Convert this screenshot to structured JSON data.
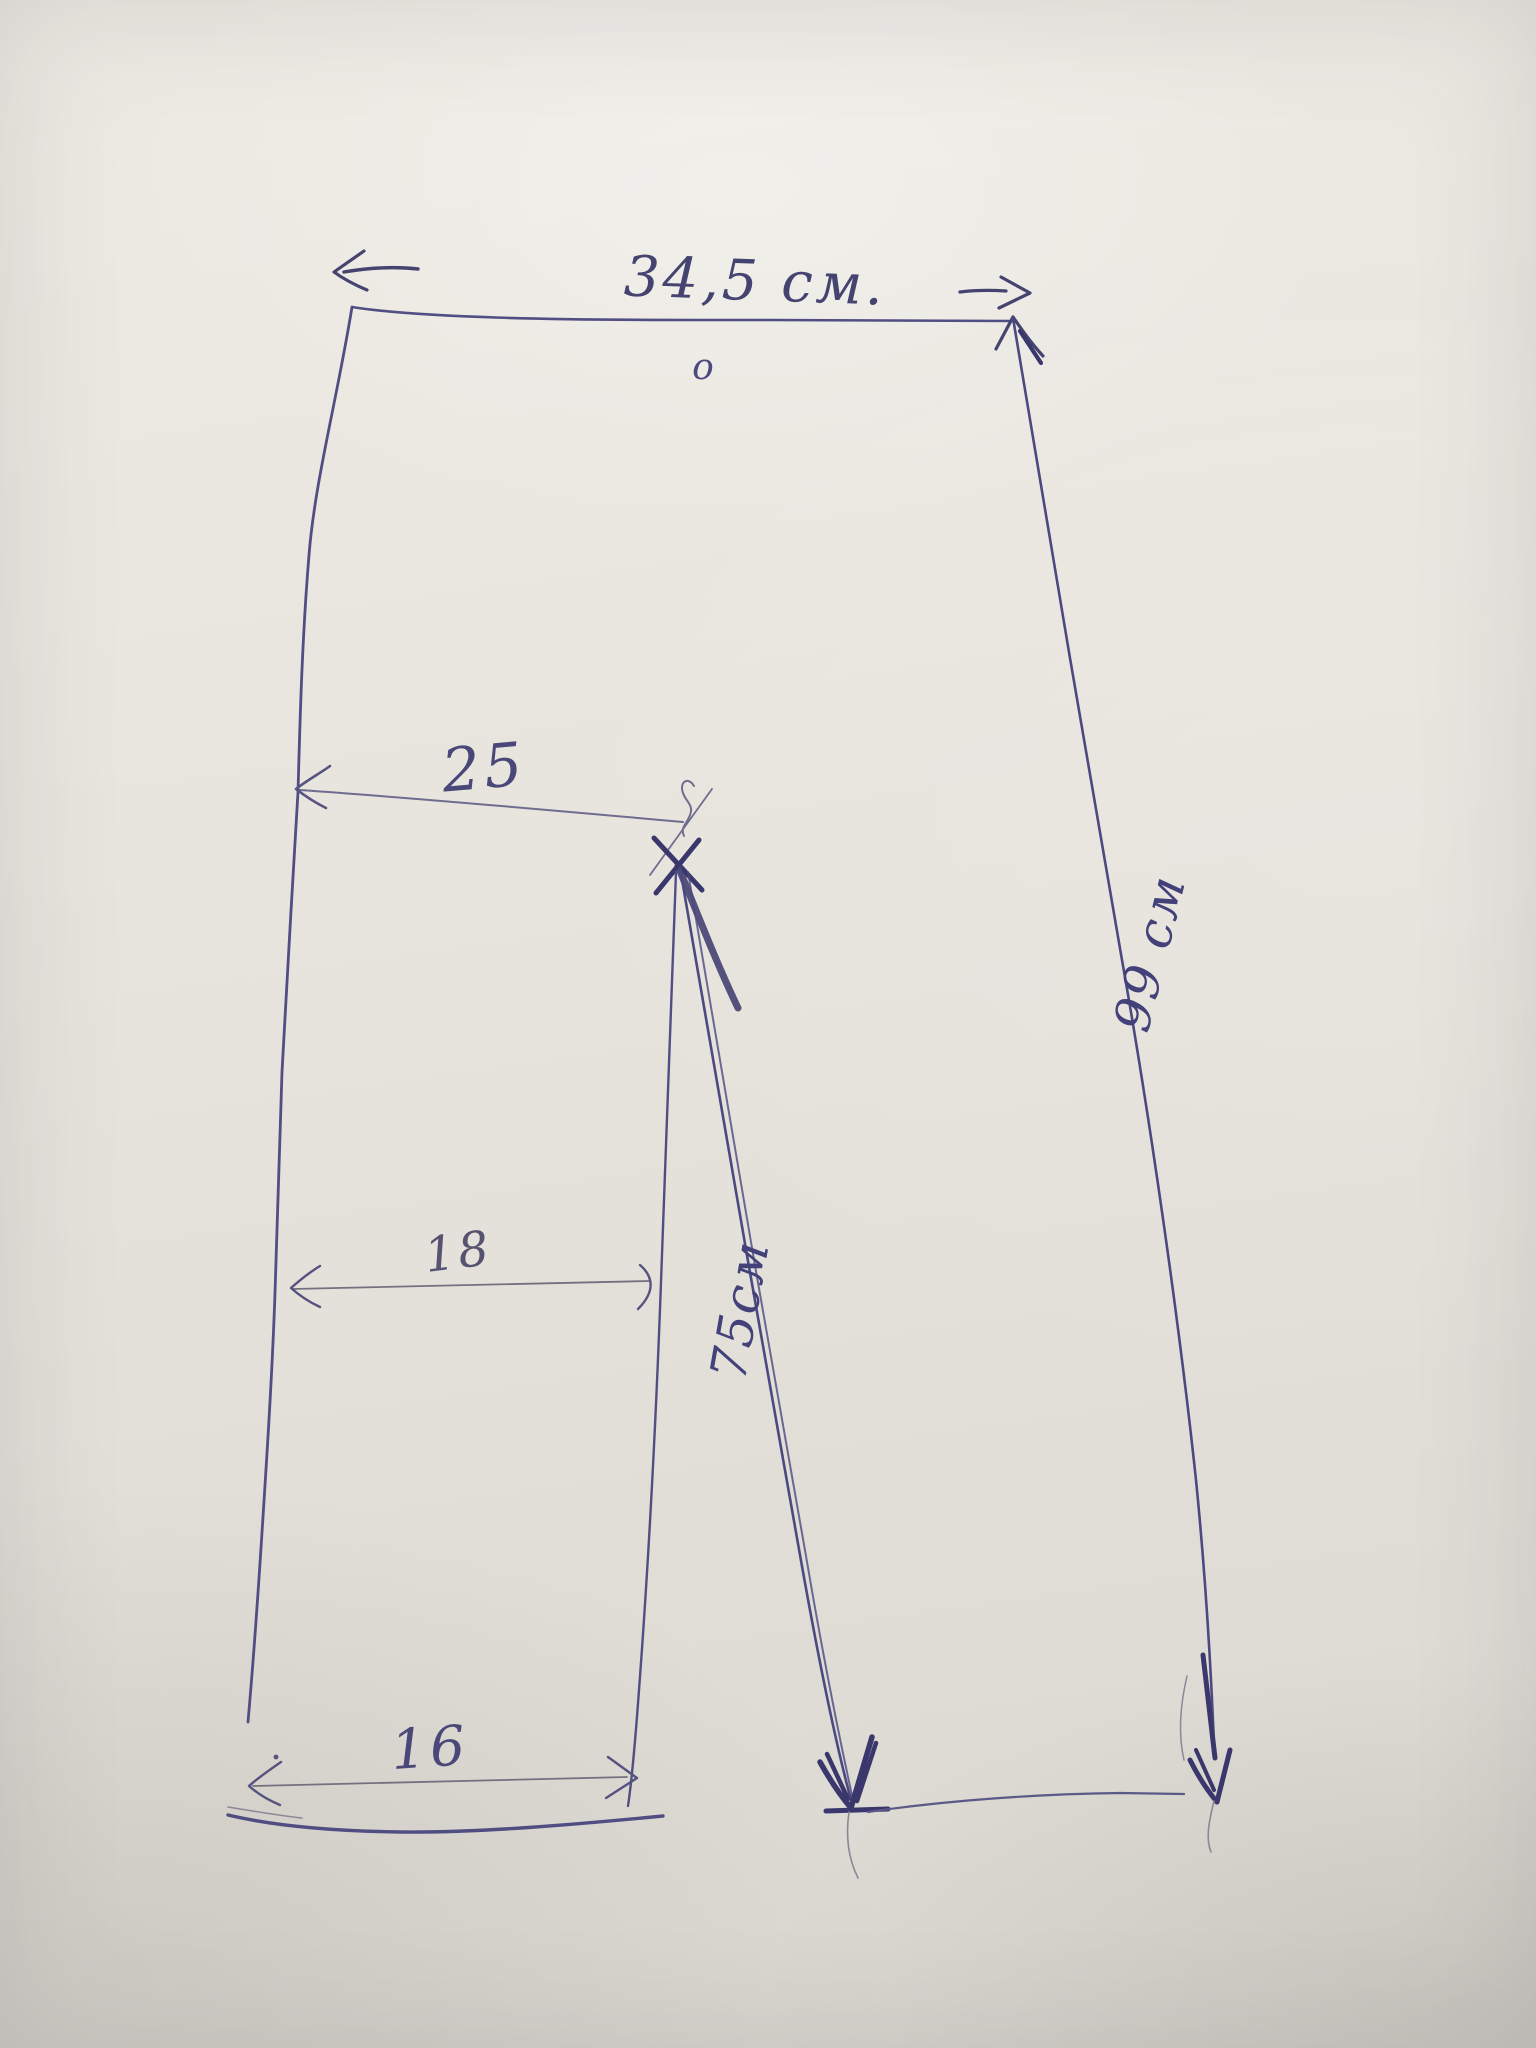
{
  "sketch": {
    "paper_color": "#e7e4dd",
    "ink_color": "#403e74",
    "labels": {
      "waist_width": "34,5 см.",
      "waist_mark": "о",
      "hip_width": "25",
      "knee_width": "18",
      "hem_width": "16",
      "inseam_length": "75см",
      "outseam_length": "99 см"
    }
  }
}
